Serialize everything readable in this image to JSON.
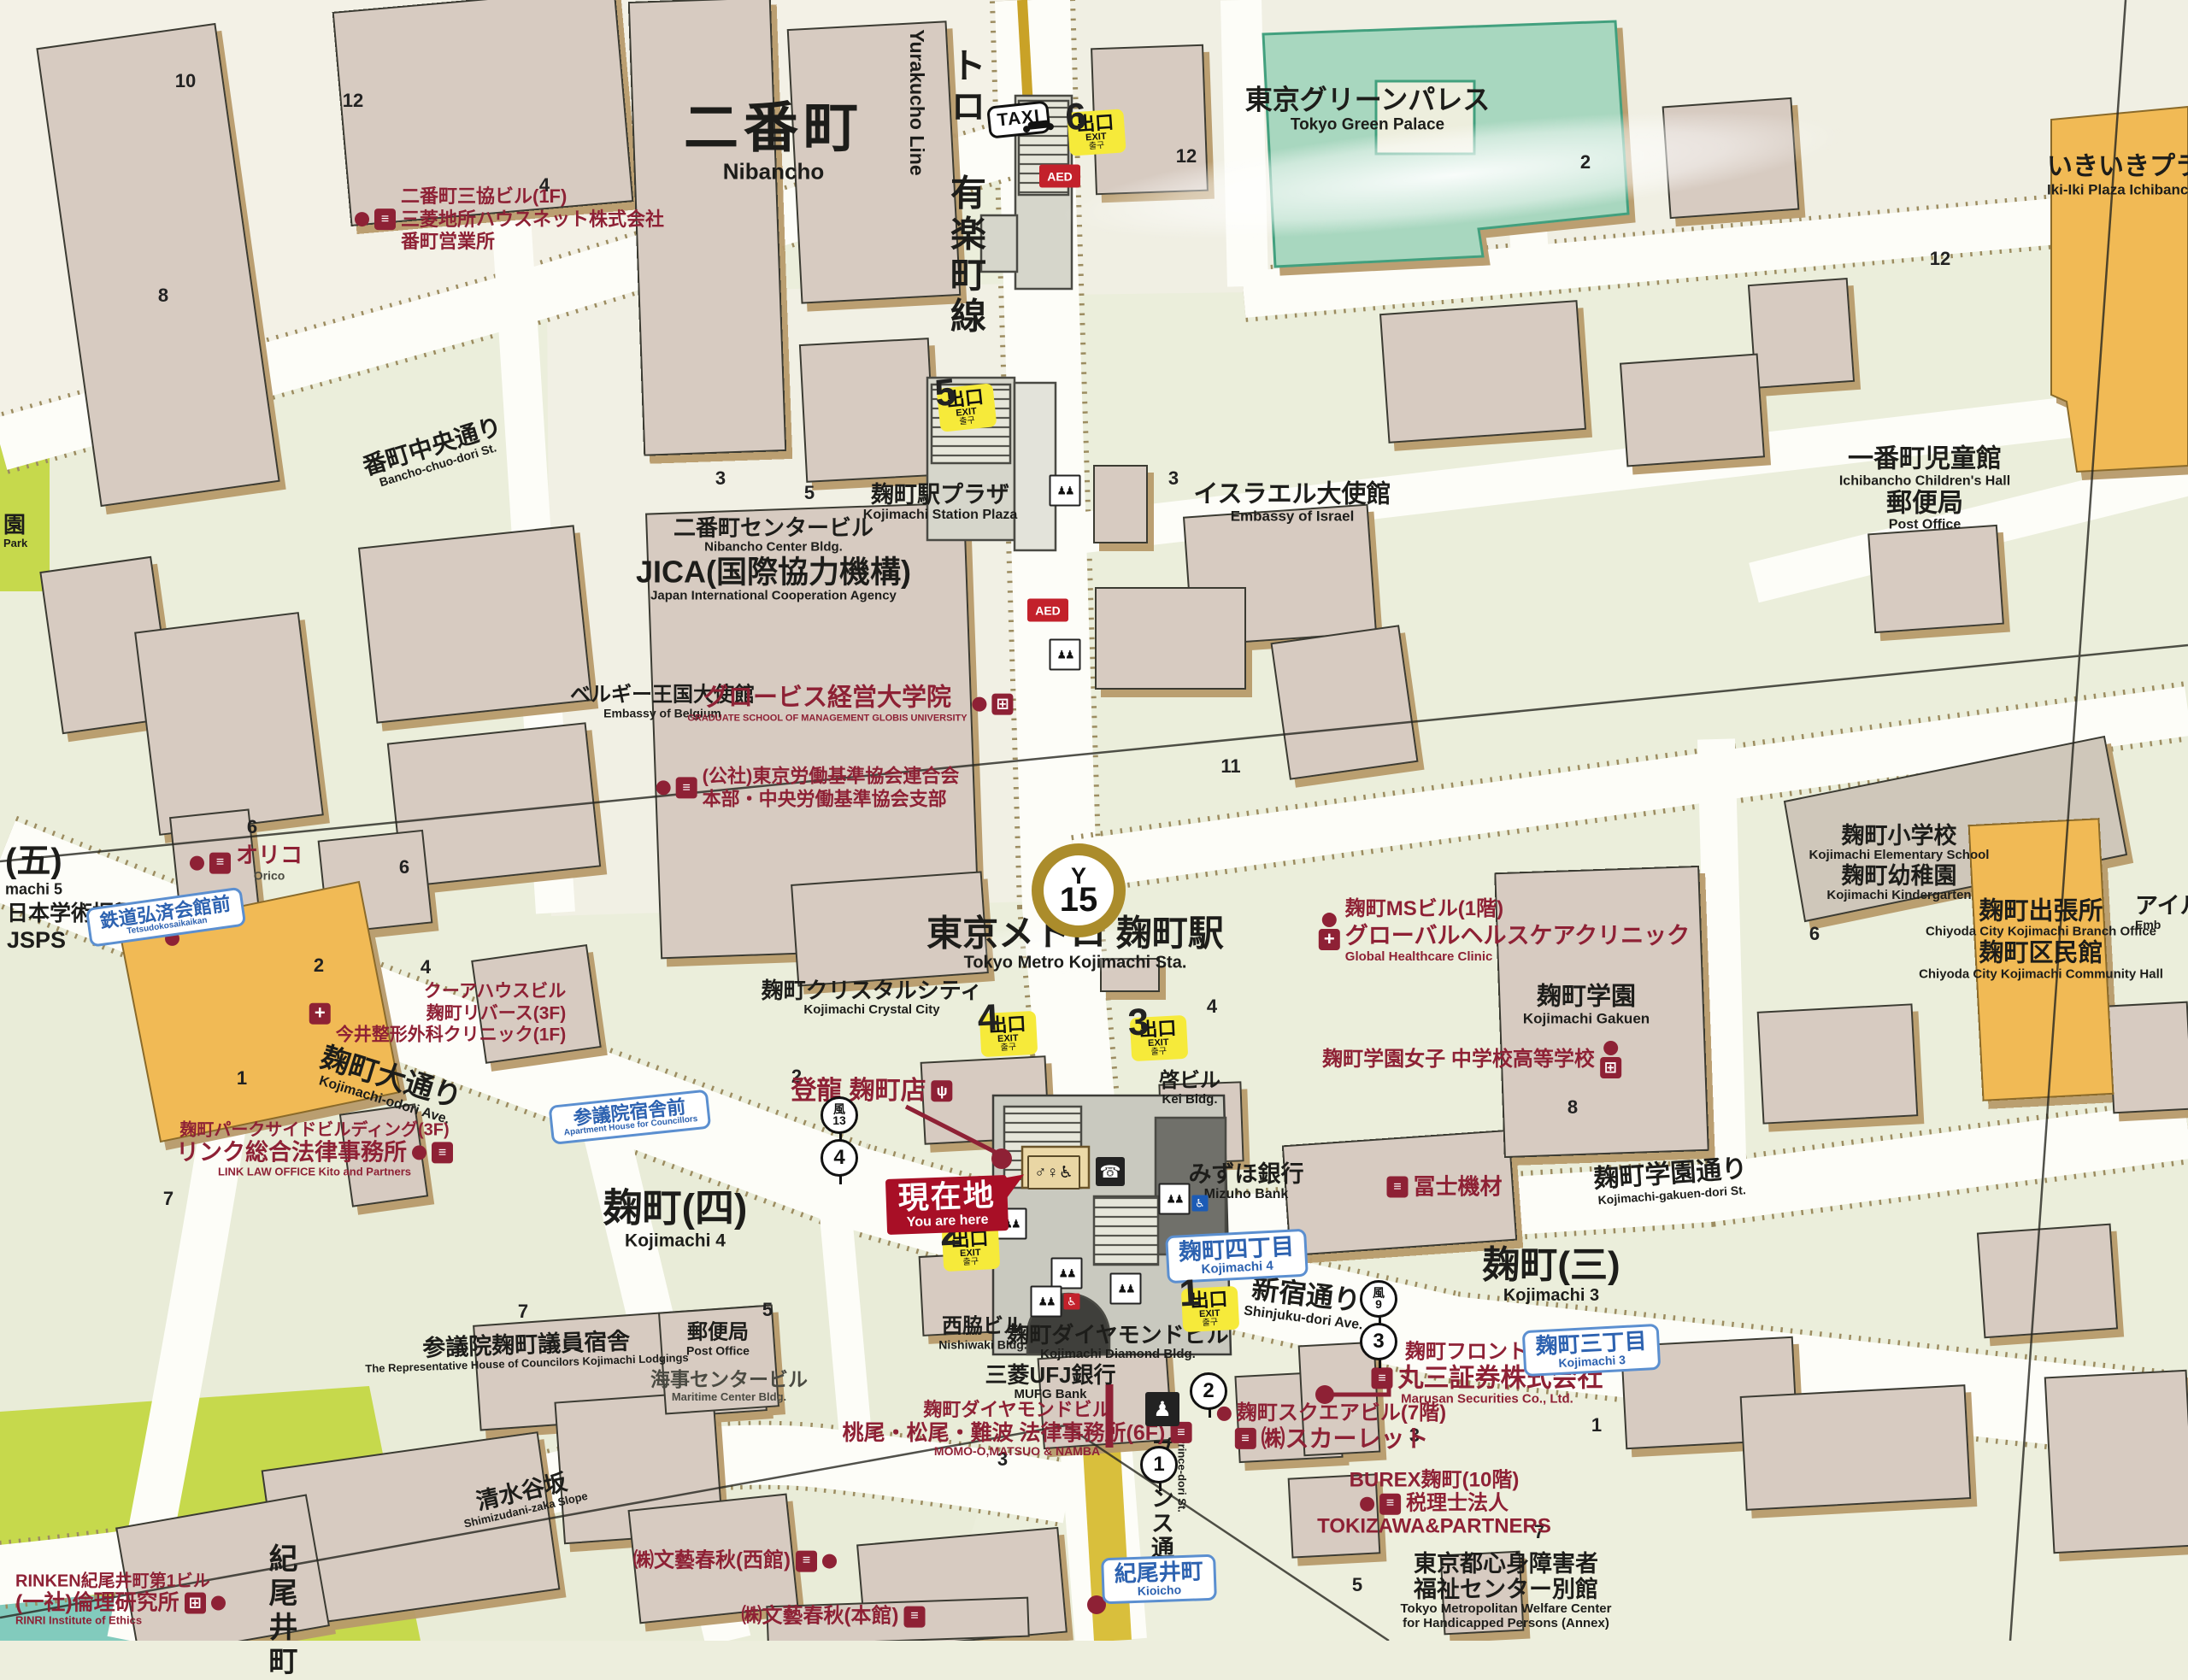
{
  "station": {
    "line_v_jp": "トロ 有楽町線",
    "line_v_en": "Yurakucho Line",
    "roundel_line": "Y",
    "roundel_num": "15",
    "name_jp": "東京メトロ 麹町駅",
    "name_en": "Tokyo Metro Kojimachi Sta."
  },
  "ui": {
    "exit_jp": "出口",
    "exit_en": "EXIT",
    "exit_kr": "출구",
    "taxi": "TAXI",
    "aed": "AED",
    "here_jp": "現在地",
    "here_en": "You are here",
    "toilet": "♂♀♿",
    "phone": "☎",
    "police": "♟",
    "elevator": "♟♟",
    "wheel": "♿"
  },
  "exits": [
    "1",
    "2",
    "3",
    "4",
    "5",
    "6"
  ],
  "bus": {
    "kaze": "風",
    "n13": "13",
    "n9": "9",
    "c4": "4",
    "c3": "3",
    "c2": "2",
    "c1": "1"
  },
  "blocks": [
    "10",
    "12",
    "8",
    "4",
    "12",
    "2",
    "12",
    "3",
    "3",
    "5",
    "6",
    "6",
    "2",
    "4",
    "1",
    "11",
    "7",
    "7",
    "5",
    "4",
    "6",
    "8",
    "2",
    "3",
    "3",
    "1",
    "7",
    "5"
  ],
  "districts": {
    "nibancho_jp": "二番町",
    "nibancho_en": "Nibancho",
    "k4_jp": "麹町(四)",
    "k4_en": "Kojimachi 4",
    "k3_jp": "麹町(三)",
    "k3_en": "Kojimachi 3",
    "k5_jp": "(五)",
    "k5_en": "machi 5",
    "park_jp": "園",
    "park_en": "Park",
    "kioicho_v": "紀尾井町"
  },
  "signs": {
    "tetsudo_jp": "鉄道弘済会館前",
    "tetsudo_en": "Tetsudokosaikaikan",
    "sangiin_jp": "参議院宿舎前",
    "sangiin_en": "Apartment House for Councillors",
    "k4_jp": "麹町四丁目",
    "k4_en": "Kojimachi 4",
    "k3_jp": "麹町三丁目",
    "k3_en": "Kojimachi 3",
    "kioicho_jp": "紀尾井町",
    "kioicho_en": "Kioicho"
  },
  "roads": {
    "bancho_jp": "番町中央通り",
    "bancho_en": "Bancho-chuo-dori St.",
    "odori_jp": "麹町大通り",
    "odori_en": "Kojimachi-odori Ave.",
    "shinjuku_jp": "新宿通り",
    "shinjuku_en": "Shinjuku-dori Ave.",
    "gakuen_jp": "麹町学園通り",
    "gakuen_en": "Kojimachi-gakuen-dori St.",
    "prince_jp": "プリンス通り",
    "prince_en": "Prince-dori St.",
    "shimizu_jp": "清水谷坂",
    "shimizu_en": "Shimizudani-zaka Slope"
  },
  "places": {
    "palace_jp": "東京グリーンパレス",
    "palace_en": "Tokyo Green Palace",
    "ikiiki_jp": "いきいきプラザ一番町",
    "ikiiki_en": "Iki-Iki Plaza Ichibancho",
    "childhall_jp": "一番町児童館",
    "childhall_en": "Ichibancho Children's Hall",
    "po_jp": "郵便局",
    "po_en": "Post Office",
    "plaza_jp": "麹町駅プラザ",
    "plaza_en": "Kojimachi Station Plaza",
    "nibctr_jp": "二番町センタービル",
    "nibctr_en": "Nibancho Center Bldg.",
    "jica_jp": "JICA(国際協力機構)",
    "jica_en": "Japan International Cooperation Agency",
    "belgium_jp": "ベルギー王国大使館",
    "belgium_en": "Embassy of Belgium",
    "israel_jp": "イスラエル大使館",
    "israel_en": "Embassy of Israel",
    "jsps_jp": "日本学術振興会",
    "jsps_en": "JSPS",
    "crystal_jp": "麹町クリスタルシティ",
    "crystal_en": "Kojimachi Crystal City",
    "kei_jp": "啓ビル",
    "kei_en": "Kei Bldg.",
    "gakuen_jp": "麹町学園",
    "gakuen_en": "Kojimachi Gakuen",
    "elem_jp": "麹町小学校",
    "elem_en": "Kojimachi Elementary School",
    "kinder_jp": "麹町幼稚園",
    "kinder_en": "Kojimachi Kindergarten",
    "branch_jp": "麹町出張所",
    "branch_en": "Chiyoda City Kojimachi Branch Office",
    "community_jp": "麹町区民館",
    "community_en": "Chiyoda City Kojimachi Community Hall",
    "ireland_jp": "アイル",
    "ireland_en": "Emb",
    "mizuho_jp": "みずほ銀行",
    "mizuho_en": "Mizuho Bank",
    "nishiwaki_jp": "西脇ビル",
    "nishiwaki_en": "Nishiwaki Bldg.",
    "diamond_jp": "麹町ダイヤモンドビル",
    "diamond_en": "Kojimachi Diamond Bldg.",
    "mufg_jp": "三菱UFJ銀行",
    "mufg_en": "MUFG Bank",
    "lodgings_jp": "参議院麹町議員宿舎",
    "lodgings_en": "The Representative House of Councilors Kojimachi Lodgings",
    "maritime_jp": "海事センタービル",
    "maritime_en": "Maritime Center Bldg.",
    "welfare_jp1": "東京都心身障害者",
    "welfare_jp2": "福祉センター別館",
    "welfare_en1": "Tokyo Metropolitan Welfare Center",
    "welfare_en2": "for Handicapped Persons (Annex)"
  },
  "biz": {
    "sankyo_l1": "二番町三協ビル(1F)",
    "sankyo_l2": "三菱地所ハウスネット株式会社",
    "sankyo_l3": "番町営業所",
    "globis_jp": "グロービス経営大学院",
    "globis_en": "GRADUATE SCHOOL OF MANAGEMENT GLOBIS UNIVERSITY",
    "rodo_l1": "(公社)東京労働基準協会連合会",
    "rodo_l2": "本部・中央労働基準協会支部",
    "orico_jp": "オリコ",
    "orico_en": "Orico",
    "kua_l1": "クーアハウスビル",
    "kua_l2": "麹町リバース(3F)",
    "kua_l3": "今井整形外科クリニック(1F)",
    "link_l1": "麹町パークサイドビルディング(3F)",
    "link_l2": "リンク総合法律事務所",
    "link_en": "LINK LAW OFFICE Kito and Partners",
    "ms_l1": "麹町MSビル(1階)",
    "ms_l2": "グローバルヘルスケアクリニック",
    "ms_en": "Global Healthcare Clinic",
    "joshi": "麹町学園女子 中学校高等学校",
    "fuji": "冨士機材",
    "toryu": "登龍 麹町店",
    "marusan_l1": "麹町フロントビル",
    "marusan_l2": "丸三証券株式会社",
    "marusan_en": "Marusan Securities Co., Ltd.",
    "scarlet_l1": "麹町スクエアビル(7階)",
    "scarlet_l2": "㈱スカーレット",
    "burex_l1": "BUREX麹町(10階)",
    "burex_l2": "税理士法人",
    "burex_l3": "TOKIZAWA&PARTNERS",
    "momoo_l1": "麹町ダイヤモンドビル",
    "momoo_l2": "桃尾・松尾・難波 法律事務所(6F)",
    "momoo_en": "MOMO-O,MATSUO & NAMBA",
    "bungei_w": "㈱文藝春秋(西館)",
    "bungei_m": "㈱文藝春秋(本館)",
    "rinken_l1": "RINKEN紀尾井町第1ビル",
    "rinken_l2": "(一社)倫理研究所",
    "rinken_en": "RINRI Institute of Ethics"
  }
}
